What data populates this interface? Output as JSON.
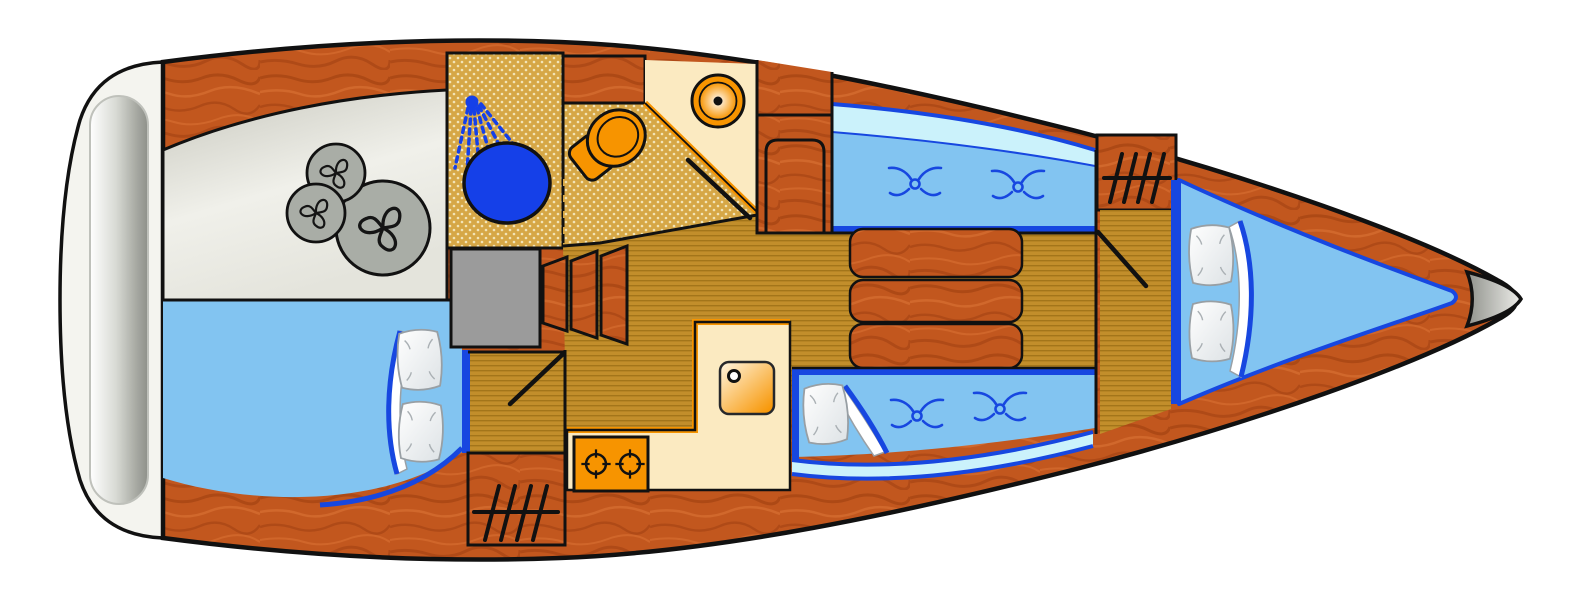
{
  "diagram": {
    "kind": "sailboat-interior-floorplan",
    "view": "top-down",
    "orientation": "bow-right"
  },
  "areas": [
    {
      "id": "swim-platform",
      "features": [
        "transom-ladder"
      ]
    },
    {
      "id": "cockpit-locker",
      "features": [
        "propeller-symbol",
        "propeller-symbol",
        "propeller-symbol"
      ]
    },
    {
      "id": "aft-cabin-berth",
      "features": [
        "pillow",
        "pillow",
        "blanket"
      ]
    },
    {
      "id": "head-shower",
      "features": [
        "shower-head",
        "shower-basin",
        "folding-partition"
      ]
    },
    {
      "id": "head-toilet",
      "features": [
        "toilet",
        "washbasin",
        "door"
      ]
    },
    {
      "id": "companionway",
      "features": [
        "steps",
        "engine-compartment"
      ]
    },
    {
      "id": "galley",
      "features": [
        "two-burner-stove",
        "sink",
        "vent-grill"
      ]
    },
    {
      "id": "saloon",
      "features": [
        "folding-table",
        "port-settee",
        "starboard-settee",
        "cushion-symbols",
        "hull-windows"
      ]
    },
    {
      "id": "forward-cabin",
      "features": [
        "door",
        "vent-grill",
        "v-berth",
        "pillow",
        "pillow",
        "blanket"
      ]
    },
    {
      "id": "bow",
      "features": [
        "anchor-fitting"
      ]
    }
  ],
  "icons": [
    "propeller-icon",
    "shower-icon",
    "toilet-icon",
    "washbasin-icon",
    "sink-icon",
    "stove-burner-icon",
    "vent-grill-icon",
    "cushion-icon",
    "pillow-icon",
    "steps-icon",
    "door-swing-icon",
    "ladder-icon"
  ],
  "colors": {
    "bg": "#FFFFFF",
    "outline": "#111111",
    "wood": "#C2571E",
    "woodDark": "#93380C",
    "woodLight": "#E0793A",
    "teak": "#C28E2B",
    "teakLine": "#A3751A",
    "dotBase": "#D6A746",
    "dot": "#F2E4B7",
    "cockpitLight": "#F0F0EA",
    "cockpitDark": "#C8C8BE",
    "circleGray": "#A9ADA6",
    "engine": "#9B9B9B",
    "berth": "#82C4F1",
    "windowPale": "#CBF2FB",
    "accent": "#1747E0",
    "deepBlue": "#1540E8",
    "cream": "#FBEAC1",
    "orange": "#F79400",
    "transom": "#F4F4EF",
    "capGray": "#90928C",
    "pillow": "#FFFFFF"
  }
}
